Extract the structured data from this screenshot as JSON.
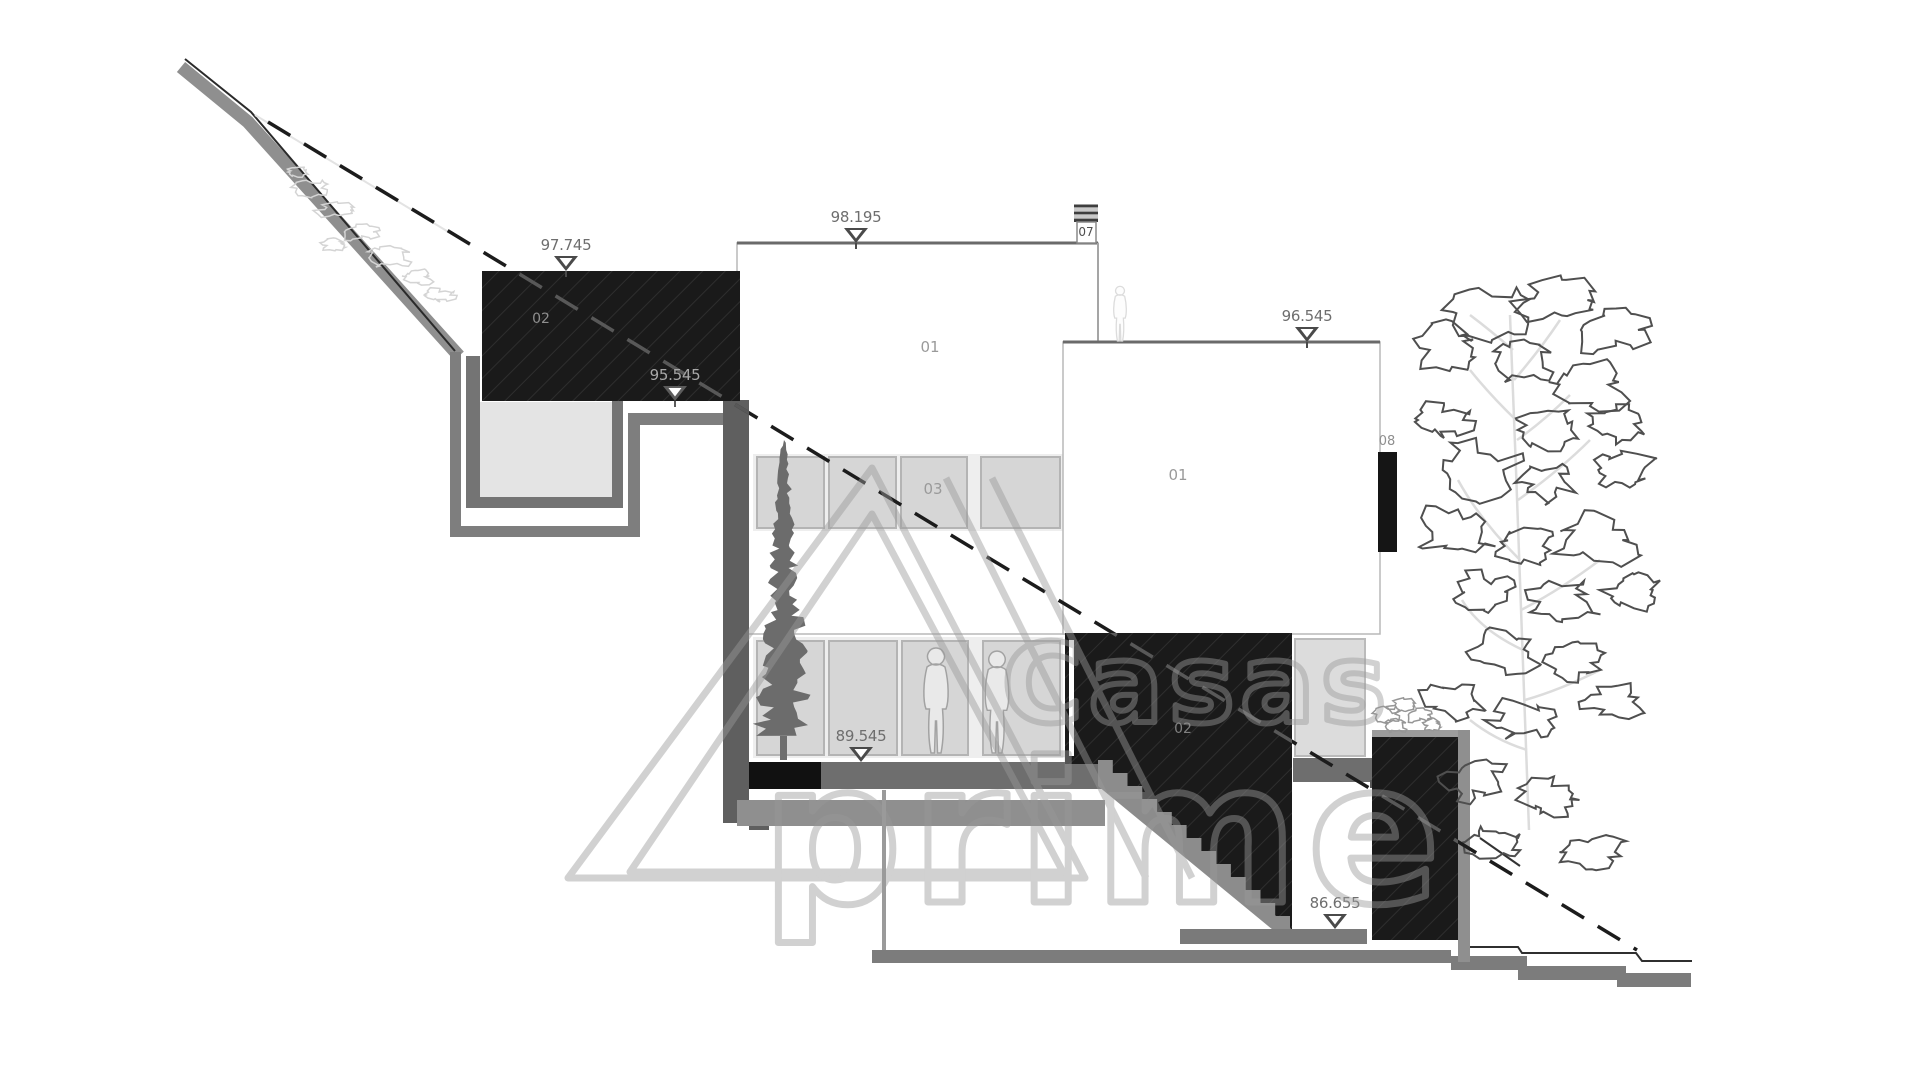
{
  "drawing_type": "architectural-section",
  "labels": {
    "roof_block": "02",
    "volume_main": "01",
    "volume_right": "01",
    "mid_level": "03",
    "stair_block": "02",
    "chimney": "07",
    "shutter": "08"
  },
  "elevation_markers": {
    "garage_roof": "97.745",
    "main_roof": "98.195",
    "right_roof": "96.545",
    "garage_floor": "95.545",
    "main_floor": "89.545",
    "basement_floor": "86.655"
  },
  "watermark": {
    "word_1": "Casas",
    "word_2": "prime"
  },
  "colors": {
    "section_dark": "#1a1a1a",
    "wall_gray": "#6e6e6e",
    "glazing_gray": "#d6d6d6",
    "terrain_gray": "#8f8f8f",
    "watermark_gray": "#9a9a9a"
  }
}
